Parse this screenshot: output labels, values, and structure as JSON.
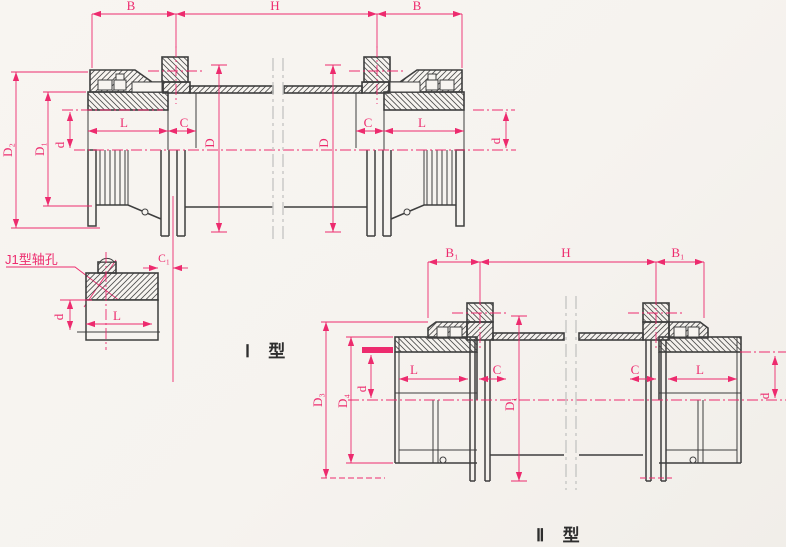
{
  "colors": {
    "dimension_pink": "#ed2b6e",
    "drawing_line": "#3e3e3e",
    "break_line": "#c7c7c5",
    "paper": "#f7f4f0"
  },
  "type1": {
    "label": "Ⅰ 型",
    "shaft_hole_callout": "J1型轴孔",
    "dims": {
      "B_left": "B",
      "H": "H",
      "B_right": "B",
      "D2": "D₂",
      "D1": "D₁",
      "d_left": "d",
      "L_left": "L",
      "C_left": "C",
      "D_left": "D",
      "D_right": "D",
      "C_right": "C",
      "L_right": "L",
      "d_right": "d",
      "C1": "C₁",
      "hub_d": "d",
      "hub_L": "L"
    }
  },
  "type2": {
    "label": "Ⅱ 型",
    "dims": {
      "B1_left": "B₁",
      "H": "H",
      "B1_right": "B₁",
      "D3": "D₃",
      "D4": "D₄",
      "d_left": "d",
      "L_left": "L",
      "C_left": "C",
      "D1": "D₁",
      "C_right": "C",
      "L_right": "L",
      "d_right": "d"
    }
  }
}
